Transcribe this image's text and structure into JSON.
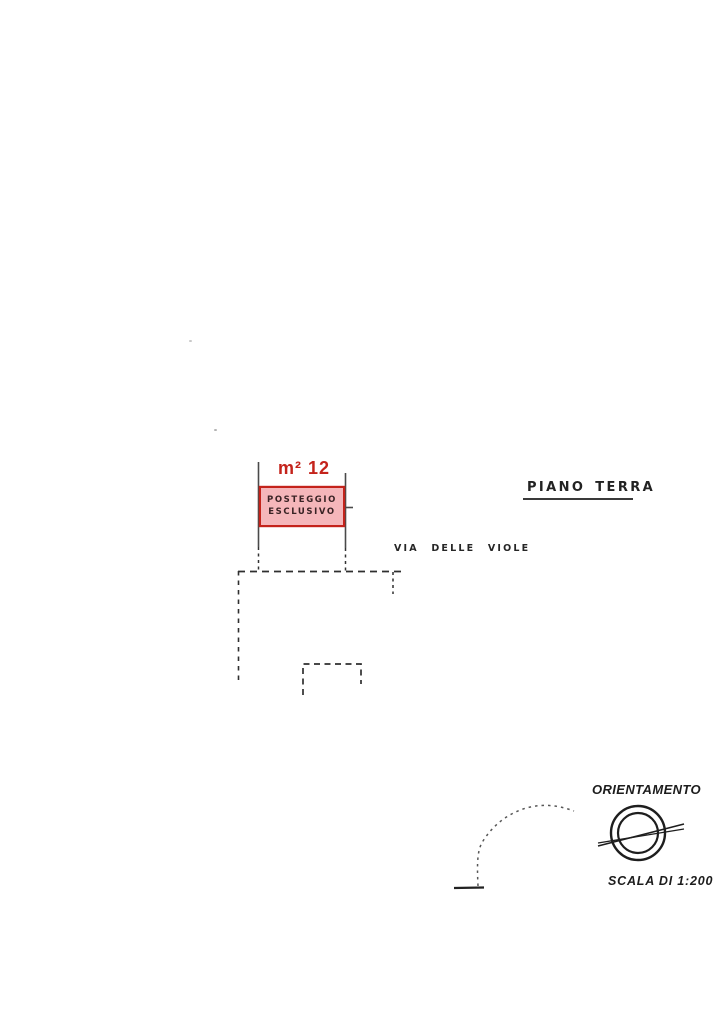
{
  "document": {
    "type_note": "scanned cadastral floor plan",
    "floor_label": "PIANO TERRA",
    "street_label": "VIA DELLE VIOLE",
    "area_label": "m² 12",
    "parking_line1": "POSTEGGIO",
    "parking_line2": "ESCLUSIVO",
    "orientation_label": "ORIENTAMENTO",
    "scale_label": "SCALA DI 1:200"
  },
  "colors": {
    "highlight_red": "#c4231b",
    "highlight_pink_fill": "#f5b6ba",
    "ink": "#2e2e2e",
    "paper": "#ffffff"
  }
}
